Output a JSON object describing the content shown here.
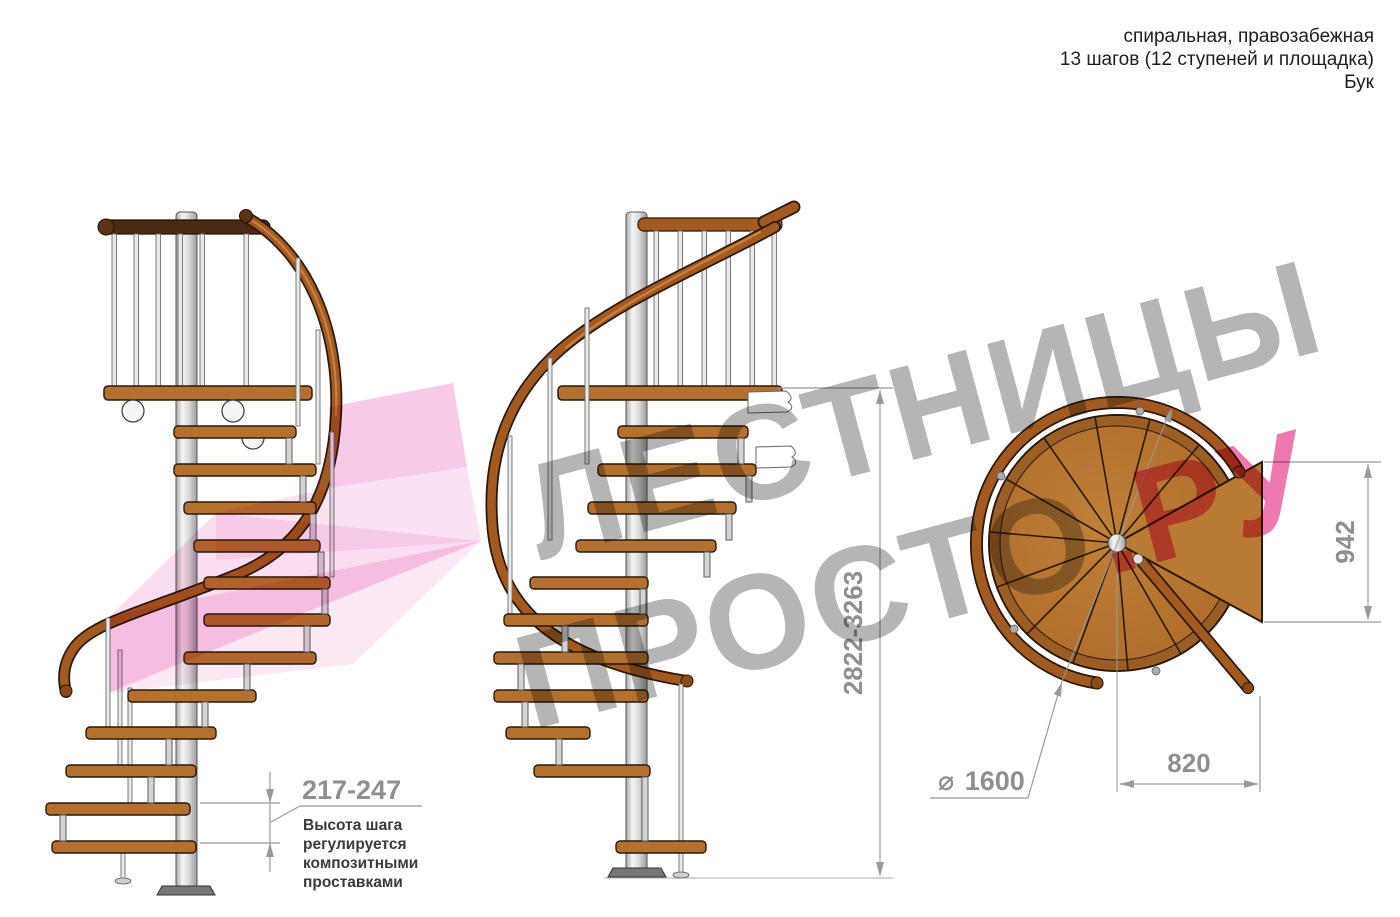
{
  "header": {
    "lines": [
      "спиральная, правозабежная",
      "13 шагов (12 ступеней и площадка)",
      "Бук"
    ]
  },
  "dimensions": {
    "total_height": "2822-3263",
    "landing_depth": "942",
    "tread_width": "820",
    "diameter_symbol": "⌀",
    "diameter_value": "1600",
    "step_height_range": "217-247"
  },
  "note": {
    "lines": [
      "Высота шага",
      "регулируется",
      "композитными",
      "проставками"
    ]
  },
  "watermark": {
    "line1": "ЛЕСТНИЦЫ",
    "line2_gray": "ПРОСТО",
    "line2_accent": ".РУ"
  },
  "colors": {
    "wood": "#b4702e",
    "wood_dark": "#7a4316",
    "handrail": "#a35a20",
    "top_rail_dark": "#4a2a14",
    "metal": "#d9d9d9",
    "dimension_gray": "#9a9a9a",
    "note_text": "#3a3a3a",
    "watermark_gray": "#b5b5b5",
    "watermark_pink": "#ee79b1",
    "arrow_pink": "#f1a6d7"
  }
}
